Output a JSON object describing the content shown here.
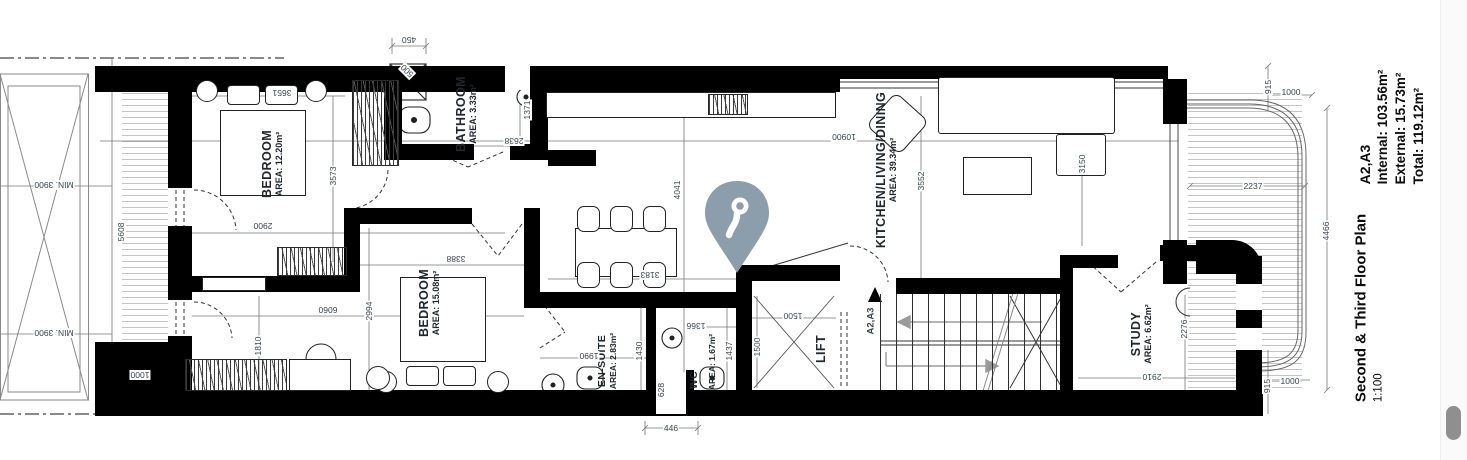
{
  "colors": {
    "wall": "#000000",
    "dimension_text": "#39434e",
    "label_text": "#20262c",
    "pin": "#8c9dab",
    "scroll_thumb": "#8f8f8f"
  },
  "title_block": {
    "sheet_refs": "A2,A3",
    "internal": "Internal: 103.56m²",
    "external": "External: 15.73m²",
    "total": "Total: 119.12m²",
    "plan_title": "Second & Third Floor Plan",
    "scale": "1:100"
  },
  "rooms": {
    "bedroom1": {
      "name": "BEDROOM",
      "area": "AREA: 12.20m²"
    },
    "bathroom": {
      "name": "BATHROOM",
      "area": "AREA: 3.33m²"
    },
    "kitchen": {
      "name": "KITCHEN/LIVING/DINING",
      "area": "AREA: 39.34m²"
    },
    "bedroom2": {
      "name": "BEDROOM",
      "area": "AREA: 15.08m²"
    },
    "ensuite": {
      "name": "EN-SUITE",
      "area": "AREA: 2.83m²"
    },
    "wc": {
      "name": "WC",
      "area": "AREA: 1.67m²"
    },
    "lift": {
      "name": "LIFT"
    },
    "study": {
      "name": "STUDY",
      "area": "AREA: 6.62m²"
    }
  },
  "annotations": {
    "min_width_top": "MIN. 3900",
    "min_width_bottom": "MIN. 3900",
    "stair_ref": "A2,A3"
  },
  "dims": {
    "d450": "450",
    "d500": "500",
    "d3651": "3651",
    "d3573": "3573",
    "d2900": "2900",
    "d1371": "1371",
    "d2638": "2638",
    "d5608": "5608",
    "d1000_left": "1000",
    "d1810": "1810",
    "d6060": "6060",
    "d2994": "2994",
    "d3388": "3388",
    "d10900": "10900",
    "d4041": "4041",
    "d3552": "3552",
    "d3150": "3150",
    "d3183": "3183",
    "d1990": "1990",
    "d1430": "1430",
    "d628": "628",
    "d446": "446",
    "d1437": "1437",
    "d1366": "1366",
    "d1500_w": "1500",
    "d1500_d": "1500",
    "d2276": "2276",
    "d2910": "2910",
    "d915_top": "915",
    "d1000_top": "1000",
    "d2237": "2237",
    "d4466": "4466",
    "d915_bottom": "915",
    "d1000_bottom": "1000"
  }
}
